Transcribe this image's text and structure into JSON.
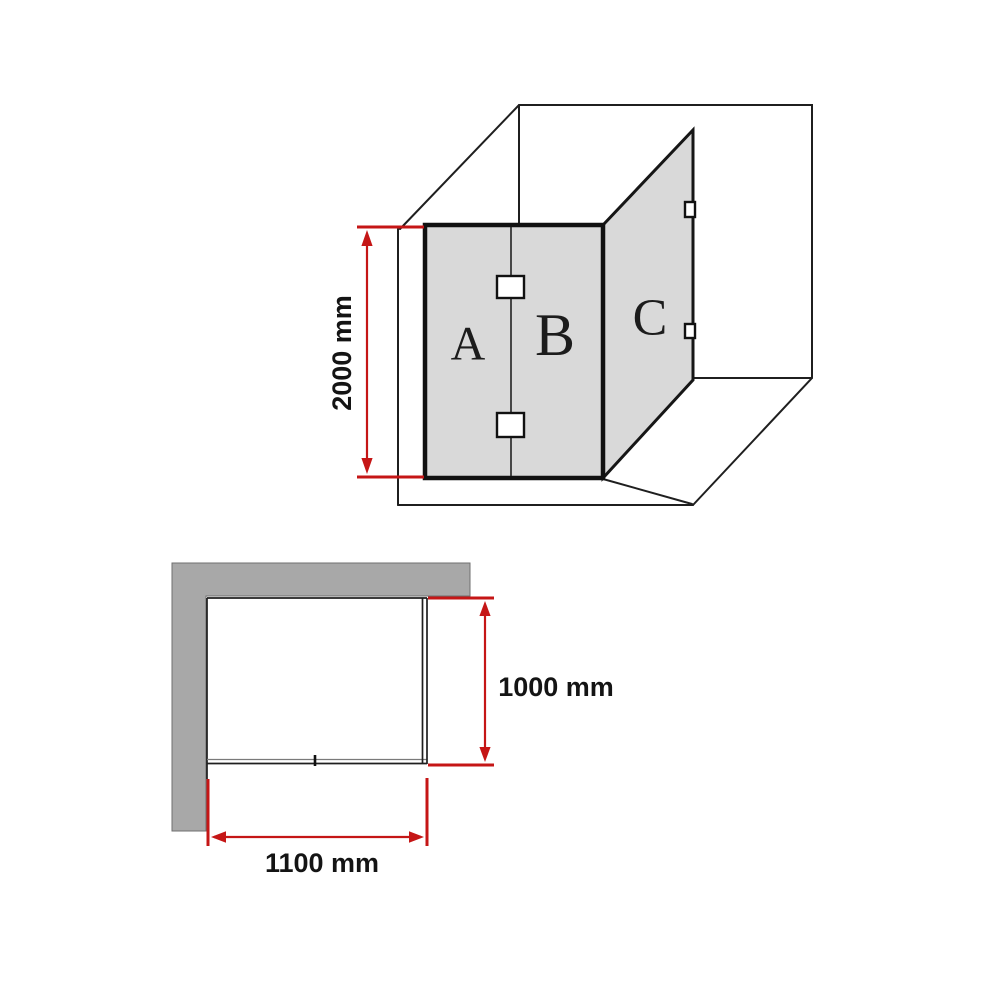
{
  "colors": {
    "dimension_red": "#c51616",
    "line_black": "#1f1f1f",
    "glass_gray": "#d9d9d9",
    "wall_gray": "#a8a8a8"
  },
  "iso_view": {
    "panels": {
      "a": "A",
      "b": "B",
      "c": "C"
    },
    "height_dimension": "2000 mm"
  },
  "plan_view": {
    "depth_dimension": "1000 mm",
    "width_dimension": "1100 mm"
  }
}
